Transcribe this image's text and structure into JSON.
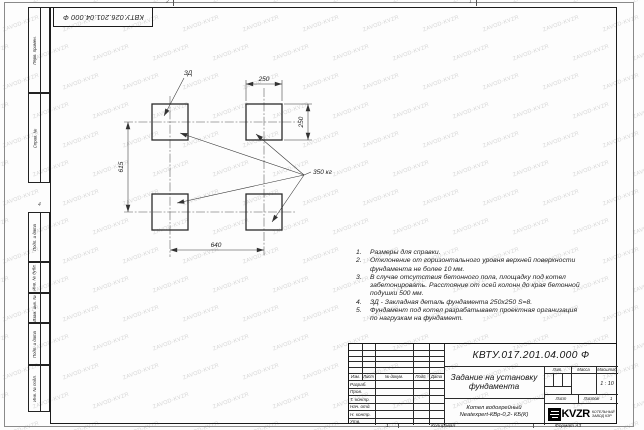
{
  "sheet": {
    "corner_code": "КВТУ.026.201.04.000 Ф",
    "zone_mark_top_left": "2",
    "zone_mark_top_right": "1",
    "zone_mark_left": "4",
    "bottom_mark": "1",
    "copy_label": "Копировал",
    "format_label": "Формат А3"
  },
  "watermark": {
    "text": "ZAVOD-KVZR"
  },
  "margin_stamps": {
    "first_application": "Перв. примен.",
    "reference_number": "Справ. №",
    "signature_date_1": "Подп. и дата",
    "inventory_duplicate": "Инв. № дубл.",
    "replaced_inventory": "Взам. инв. №",
    "signature_date_2": "Подп. и дата",
    "inventory_original": "Инв. № подл."
  },
  "drawing": {
    "embed_plate_label": "ЗД",
    "load_label": "350 кг",
    "dim_pad_width": "250",
    "dim_pad_height": "250",
    "dim_row_spacing": "615",
    "dim_col_spacing": "640"
  },
  "notes": [
    {
      "num": "1.",
      "text": "Размеры для справки."
    },
    {
      "num": "2.",
      "text": "Отклонение от горизонтального уровня верхней поверхности фундамента не более 10 мм."
    },
    {
      "num": "3.",
      "text": "В случае отсутствия бетонного пола, площадку под котел забетонировать. Расстояние от осей колонн до края бетонной подушки 500 мм."
    },
    {
      "num": "4.",
      "text": "ЗД - Закладная деталь фундамента 250х250 S=8."
    },
    {
      "num": "5.",
      "text": "Фундамент под котел разрабатывает проектная организация по нагрузкам на фундамент."
    }
  ],
  "title_block": {
    "doc_number": "КВТУ.017.201.04.000 Ф",
    "title_line1": "Задание на установку",
    "title_line2": "фундамента",
    "product_line1": "Котел водогрейный",
    "product_line2": "Neatexpert-КВр-0,2- КБ(К)",
    "header_cols": {
      "izm": "Изм.",
      "list": "Лист",
      "doc": "№ докум.",
      "sign": "Подп.",
      "date": "Дата"
    },
    "row_labels": [
      "Разраб.",
      "Пров.",
      "Т. контр.",
      "Нач. отд.",
      "Н. контр.",
      "Утв."
    ],
    "lit_label": "Лит.",
    "mass_label": "Масса",
    "scale_label": "Масштаб",
    "scale_value": "1 : 10",
    "sheet_label": "Лист",
    "sheets_label": "Листов",
    "sheets_value": "1",
    "company": {
      "logo_text": "KVZR",
      "name_line1": "КОТЕЛЬНЫЙ",
      "name_line2": "ЗАВОД КЗР"
    }
  }
}
